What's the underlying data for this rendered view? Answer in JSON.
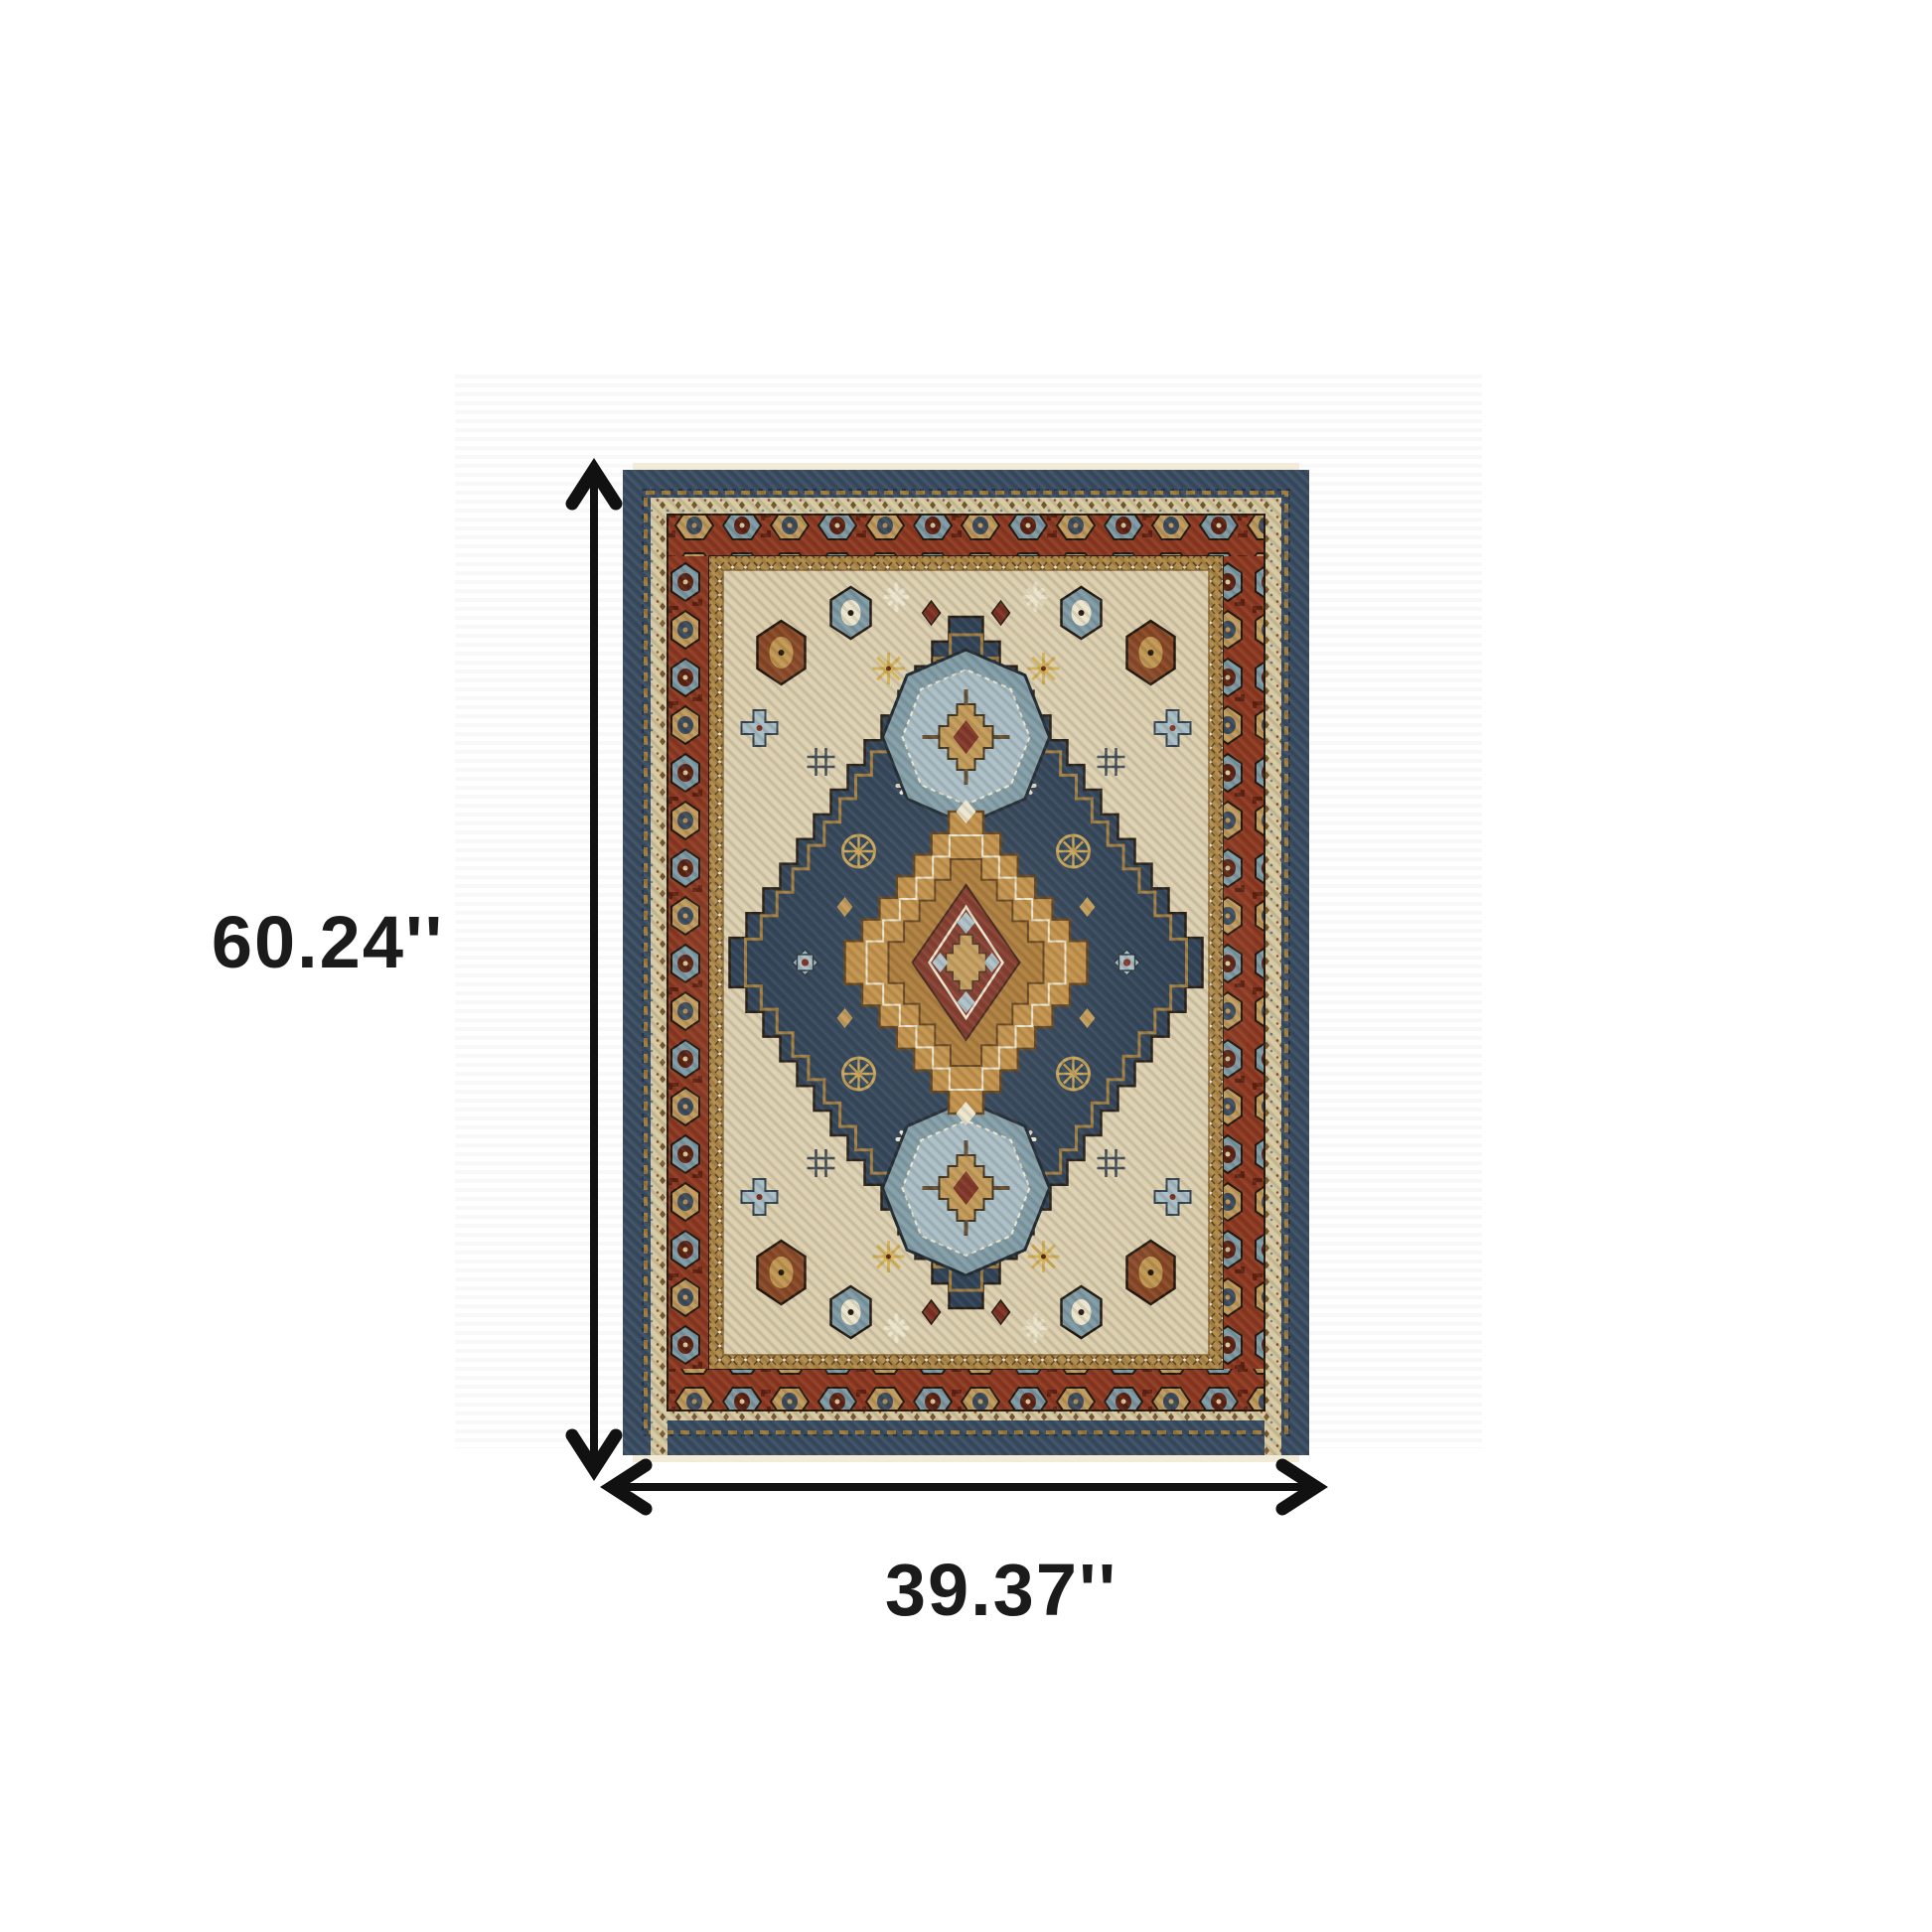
{
  "dimensions": {
    "height_label": "60.24''",
    "width_label": "39.37''"
  },
  "arrows": {
    "color": "#111111"
  },
  "labels_color": "#1b1b1b",
  "photo_background": {
    "base": "#ffffff",
    "stripe": "#f8f8f8"
  },
  "rug": {
    "colors": {
      "fringe": "#f2ebd8",
      "edge_navy": "#3b4e63",
      "edge_navy_dark": "#273747",
      "diamond_navy": "#2c3f53",
      "red_border": "#8e3a22",
      "red_dark": "#5e2313",
      "cream": "#d6c9a2",
      "cream_light": "#ece4cb",
      "gold": "#c19752",
      "gold_line": "#a07a3b",
      "gold_band": "#b08a48",
      "amber": "#bf8c41",
      "amber_dark": "#a8752f",
      "red_core": "#7c2f1f",
      "slate": "#7e9aa4",
      "slate_light": "#a7bcc3",
      "tan": "#c09a5c",
      "outline_dark": "#241a10",
      "field": "#dccfae",
      "field_line": "#8a6a38",
      "hash_dark": "#3e4a52"
    }
  }
}
